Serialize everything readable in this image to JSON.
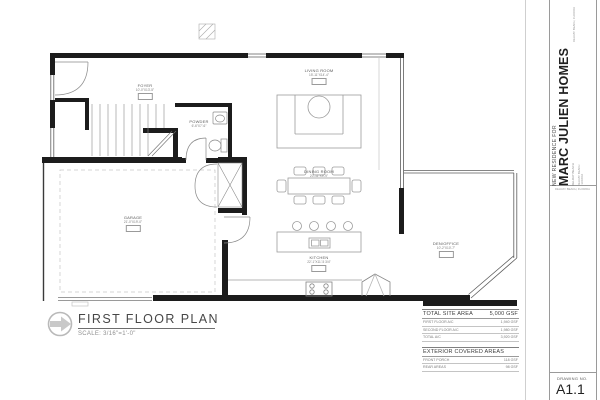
{
  "sheet": {
    "title": "FIRST FLOOR PLAN",
    "scale": "SCALE: 3/16\"=1'-0\"",
    "drawing_no_label": "DRAWING NO.",
    "drawing_no": "A1.1"
  },
  "titleblock": {
    "project_label": "NEW RESIDENCE FOR",
    "client": "MARC JULIEN HOMES",
    "subtitle": "DELRAY BEACH",
    "address_line_1": "DELRAY BEACH",
    "address_line_2": "FLORIDA",
    "margin_note": "DELRAY BEACH, FLORIDA",
    "micro_note": "DELRAY BEACH, FLORIDA"
  },
  "area_table": {
    "site_header": {
      "label": "TOTAL SITE AREA",
      "value": "5,000 GSF"
    },
    "rows": [
      {
        "label": "FIRST FLOOR A/C",
        "value": "1,940 GSF"
      },
      {
        "label": "SECOND FLOOR A/C",
        "value": "1,980 GSF"
      },
      {
        "label": "TOTAL A/C",
        "value": "3,920 GSF"
      }
    ],
    "exterior_header": {
      "label": "EXTERIOR COVERED AREAS",
      "value": ""
    },
    "exterior_rows": [
      {
        "label": "FRONT PORCH",
        "value": "118 GSF"
      },
      {
        "label": "REAR AREAS",
        "value": "98 GSF"
      }
    ]
  },
  "rooms": [
    {
      "name": "FOYER",
      "dims": "10'-0\"X13'-5\""
    },
    {
      "name": "POWDER",
      "dims": "6'-6\"X7'-6\""
    },
    {
      "name": "LIVING ROOM",
      "dims": "15'-11\"X14'-4\""
    },
    {
      "name": "DINING ROOM",
      "dims": "20'-11\"X9'-9\""
    },
    {
      "name": "KITCHEN",
      "dims": "22'-1\"X11'-5 3/4\""
    },
    {
      "name": "GARAGE",
      "dims": "21'-0\"X19'-0\""
    },
    {
      "name": "DEN/OFFICE",
      "dims": "10'-2\"X10'-7\""
    }
  ]
}
